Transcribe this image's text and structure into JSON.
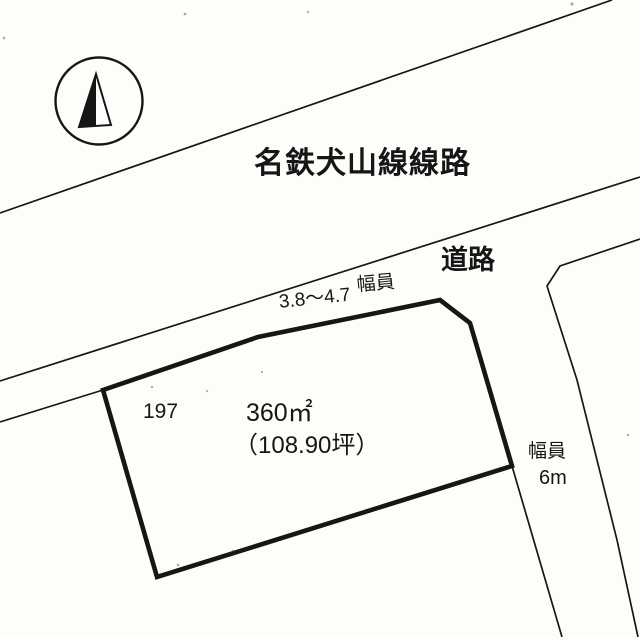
{
  "colors": {
    "background": "#fdfdfa",
    "ink": "#161616"
  },
  "compass": {
    "icon": "north-arrow"
  },
  "railway": {
    "label": "名鉄犬山線線路"
  },
  "road": {
    "label": "道路",
    "frontage_label": "幅員",
    "frontage_value": "3.8～4.7"
  },
  "side_road": {
    "width_label": "幅員",
    "width_value": "6m"
  },
  "parcel": {
    "number": "197",
    "area_sqm": "360㎡",
    "area_tsubo": "（108.90坪）"
  }
}
